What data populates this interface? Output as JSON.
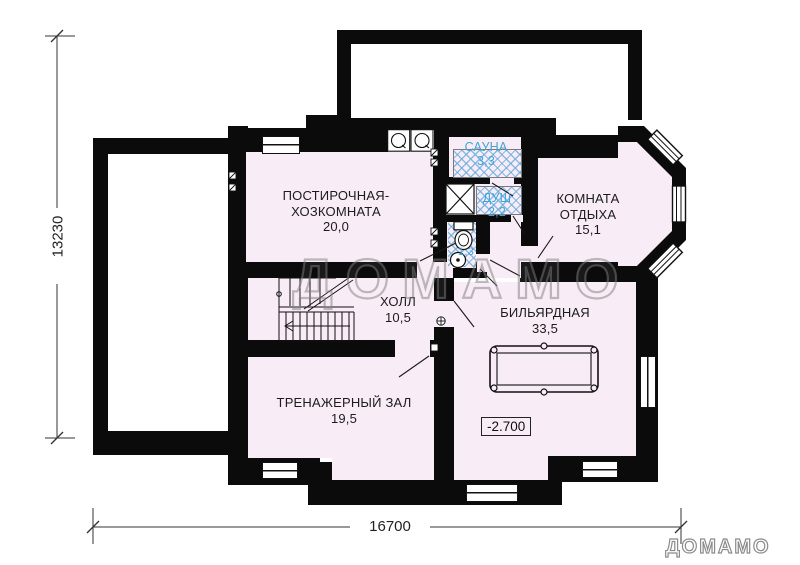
{
  "plan": {
    "type": "basement floor plan",
    "elevation_mark": "-2.700"
  },
  "rooms": {
    "laundry": {
      "line1": "ПОСТИРОЧНАЯ-",
      "line2": "ХОЗКОМНАТА",
      "area": "20,0"
    },
    "sauna": {
      "line1": "САУНА",
      "area": "3,3"
    },
    "shower": {
      "line1": "ДУШ",
      "area": "2,2"
    },
    "wc": {
      "area": "1,3"
    },
    "lounge": {
      "line1": "КОМНАТА",
      "line2": "ОТДЫХА",
      "area": "15,1"
    },
    "hall": {
      "line1": "ХОЛЛ",
      "area": "10,5"
    },
    "billiard": {
      "line1": "БИЛЬЯРДНАЯ",
      "area": "33,5"
    },
    "gym": {
      "line1": "ТРЕНАЖЕРНЫЙ ЗАЛ",
      "area": "19,5"
    }
  },
  "dimensions": {
    "height": "13230",
    "width": "16700"
  },
  "watermark": {
    "center": "ДОМАМО",
    "logo": "ДОМАМО"
  },
  "colors": {
    "wall": "#0b0b0b",
    "floor": "#f8ecf7",
    "accent_text": "#3fa6da",
    "hatch": "#64aadc"
  }
}
